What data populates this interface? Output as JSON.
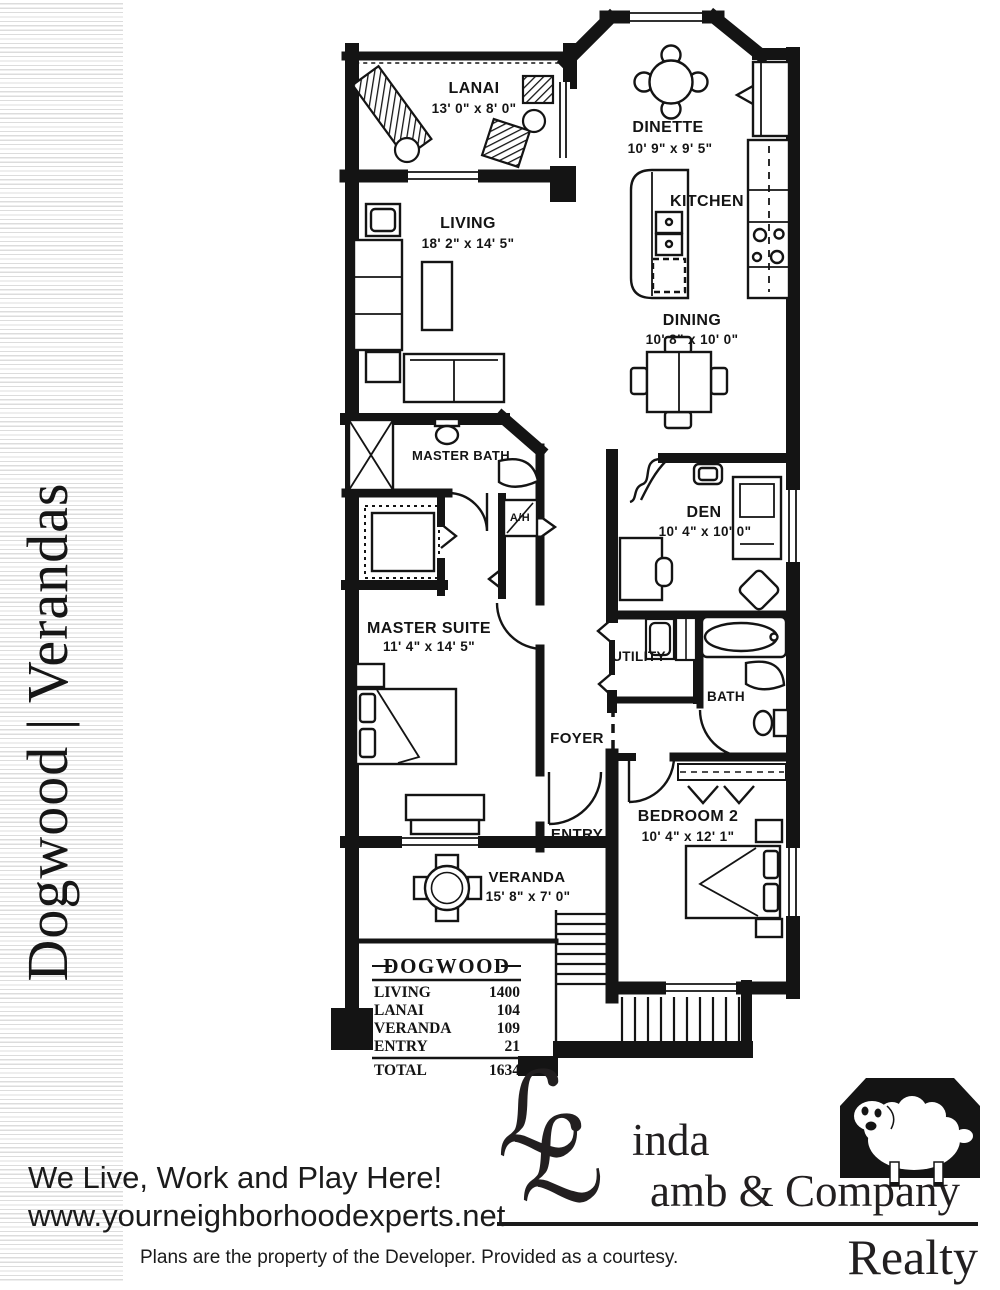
{
  "page": {
    "background": "#ffffff",
    "ink": "#141414"
  },
  "sidebar": {
    "title": "Dogwood | Verandas"
  },
  "plan": {
    "rooms": {
      "lanai": {
        "name": "LANAI",
        "dims": "13' 0\" x 8' 0\""
      },
      "dinette": {
        "name": "DINETTE",
        "dims": "10' 9\" x 9' 5\""
      },
      "kitchen": {
        "name": "KITCHEN"
      },
      "living": {
        "name": "LIVING",
        "dims": "18' 2\" x 14' 5\""
      },
      "dining": {
        "name": "DINING",
        "dims": "10' 8\" x 10' 0\""
      },
      "master_bath": {
        "name": "MASTER BATH"
      },
      "air_handler": {
        "name": "A/H"
      },
      "den": {
        "name": "DEN",
        "dims": "10' 4\" x 10' 0\""
      },
      "master_suite": {
        "name": "MASTER SUITE",
        "dims": "11' 4\" x 14' 5\""
      },
      "utility": {
        "name": "UTILITY"
      },
      "bath": {
        "name": "BATH"
      },
      "foyer": {
        "name": "FOYER"
      },
      "entry": {
        "name": "ENTRY"
      },
      "bedroom2": {
        "name": "BEDROOM 2",
        "dims": "10' 4\" x 12' 1\""
      },
      "veranda": {
        "name": "VERANDA",
        "dims": "15' 8\" x 7' 0\""
      }
    },
    "area_table": {
      "title": "DOGWOOD",
      "rows": [
        {
          "label": "LIVING",
          "value": "1400"
        },
        {
          "label": "LANAI",
          "value": "104"
        },
        {
          "label": "VERANDA",
          "value": "109"
        },
        {
          "label": "ENTRY",
          "value": "21"
        }
      ],
      "total": {
        "label": "TOTAL",
        "value": "1634"
      }
    }
  },
  "footer": {
    "tagline": "We Live, Work and Play Here!",
    "website": "www.yourneighborhoodexperts.net",
    "disclaimer": "Plans are the property of the Developer.  Provided as a courtesy."
  },
  "logo": {
    "monogram_glyph": "ℒ",
    "line1_rest": "inda",
    "line2_rest": "amb & Company",
    "division": "Realty"
  }
}
